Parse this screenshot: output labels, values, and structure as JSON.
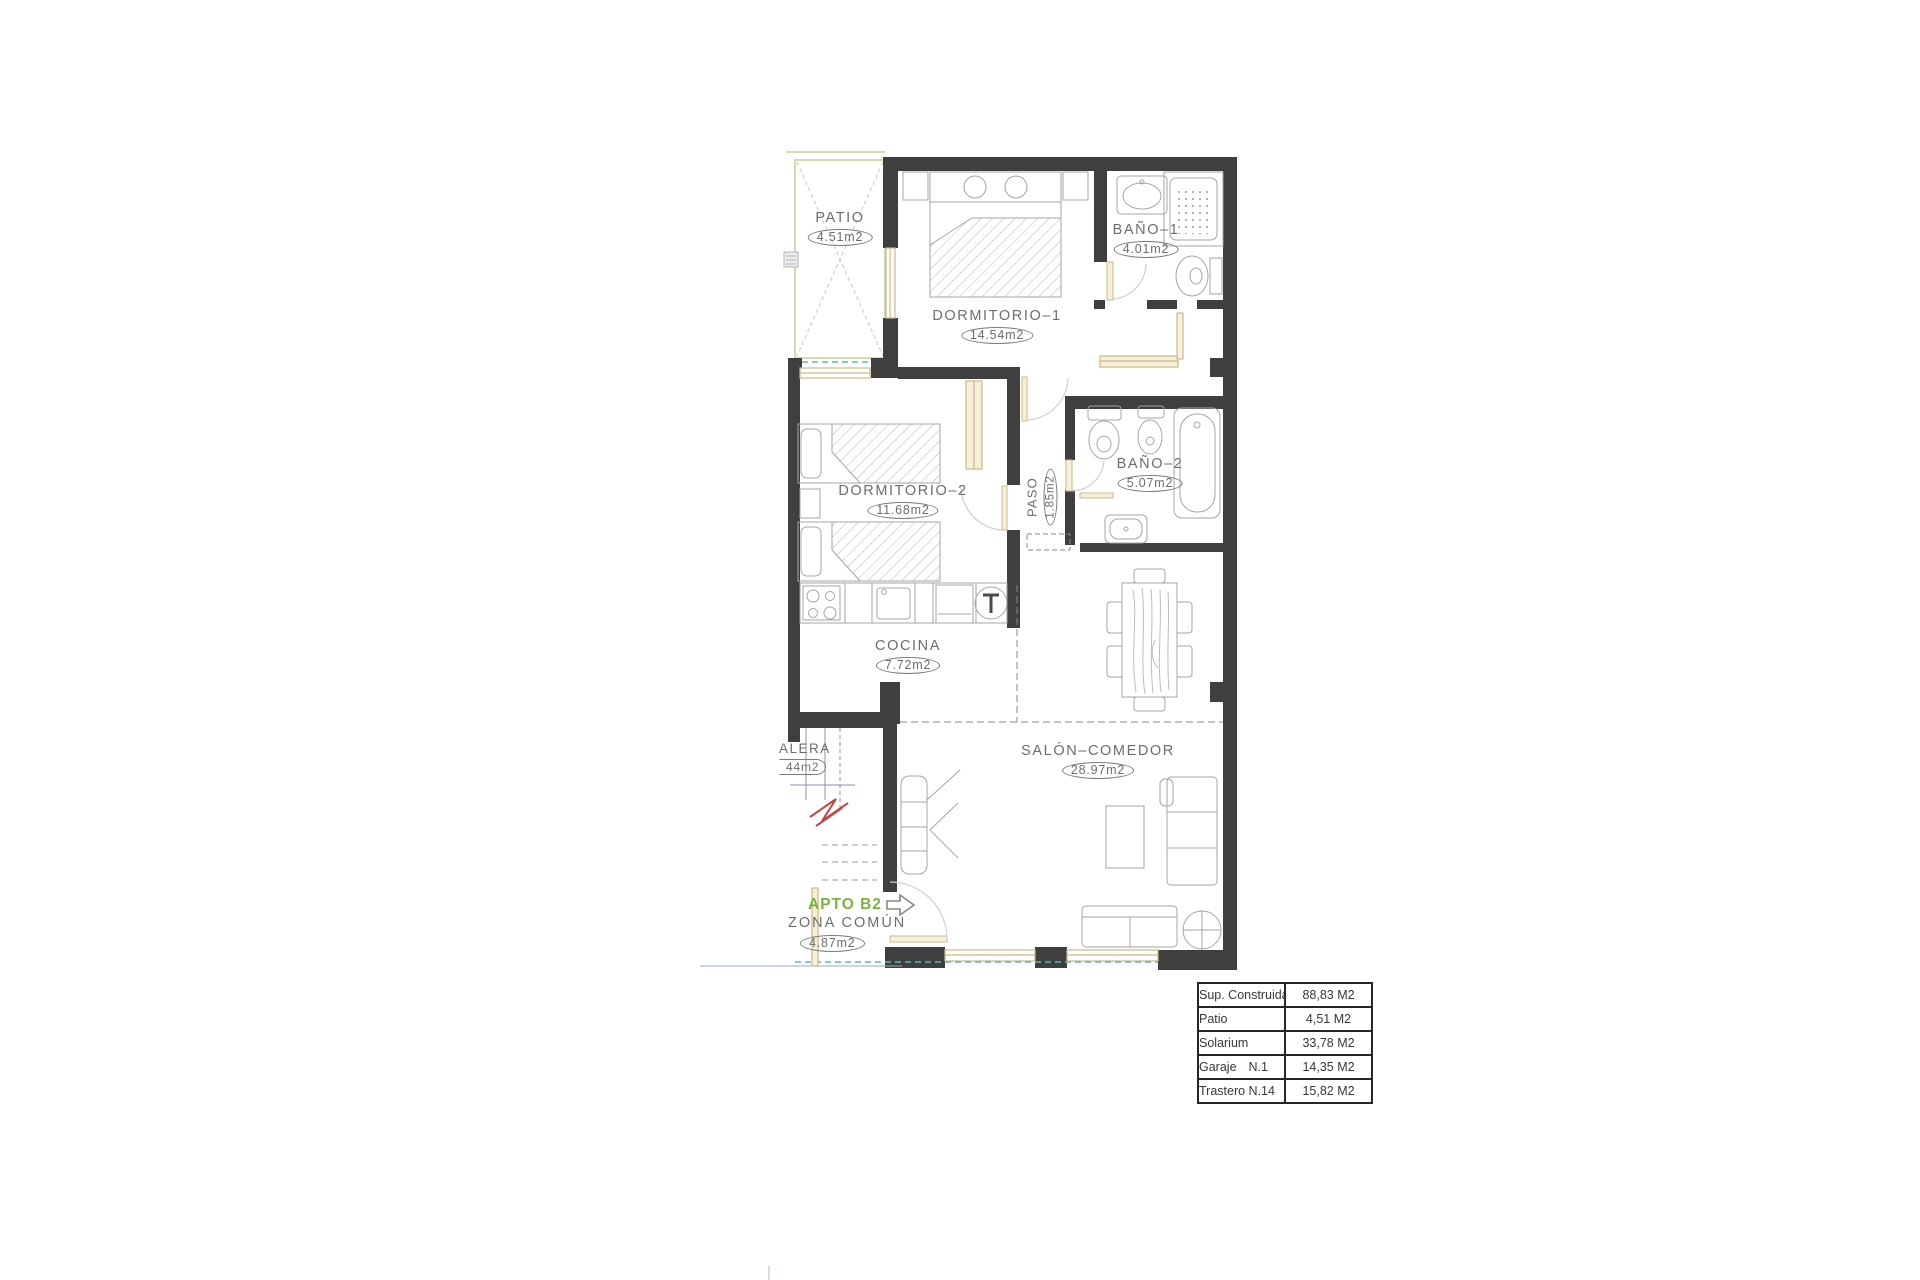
{
  "plan": {
    "apto_label": "APTO B2",
    "rooms": {
      "patio": {
        "name": "PATIO",
        "area": "4.51m2"
      },
      "dormitorio1": {
        "name": "DORMITORIO–1",
        "area": "14.54m2"
      },
      "bano1": {
        "name": "BAÑO–1",
        "area": "4.01m2"
      },
      "dormitorio2": {
        "name": "DORMITORIO–2",
        "area": "11.68m2"
      },
      "paso": {
        "name": "PASO",
        "area": "1.85m2"
      },
      "bano2": {
        "name": "BAÑO–2",
        "area": "5.07m2"
      },
      "cocina": {
        "name": "COCINA",
        "area": "7.72m2"
      },
      "salon": {
        "name": "SALÓN–COMEDOR",
        "area": "28.97m2"
      },
      "escalera": {
        "name": "ALERA",
        "area": "44m2"
      },
      "zona_comun": {
        "name": "ZONA COMÚN",
        "area": "4.87m2"
      }
    }
  },
  "summary_table": {
    "rows": [
      {
        "label": "Sup. Construida",
        "label2": "",
        "value": "88,83 M2"
      },
      {
        "label": "Patio",
        "label2": "",
        "value": "4,51 M2"
      },
      {
        "label": "Solarium",
        "label2": "",
        "value": "33,78 M2"
      },
      {
        "label": "Garaje",
        "label2": "N.1",
        "value": "14,35 M2"
      },
      {
        "label": "Trastero N.14",
        "label2": "",
        "value": "15,82 M2"
      }
    ]
  },
  "colors": {
    "wall": "#3f3f3f",
    "furniture_line": "#a5a5a5",
    "text": "#6d6d6d",
    "carpentry_tan": "#cdb989",
    "carpentry_fill": "#f6efdb",
    "patio_green": "#c9cf92",
    "teal_dash": "#5fb7b4",
    "apto_green": "#7ab33c",
    "stair_red": "#bf4a43",
    "stair_blue": "#8593b5"
  }
}
